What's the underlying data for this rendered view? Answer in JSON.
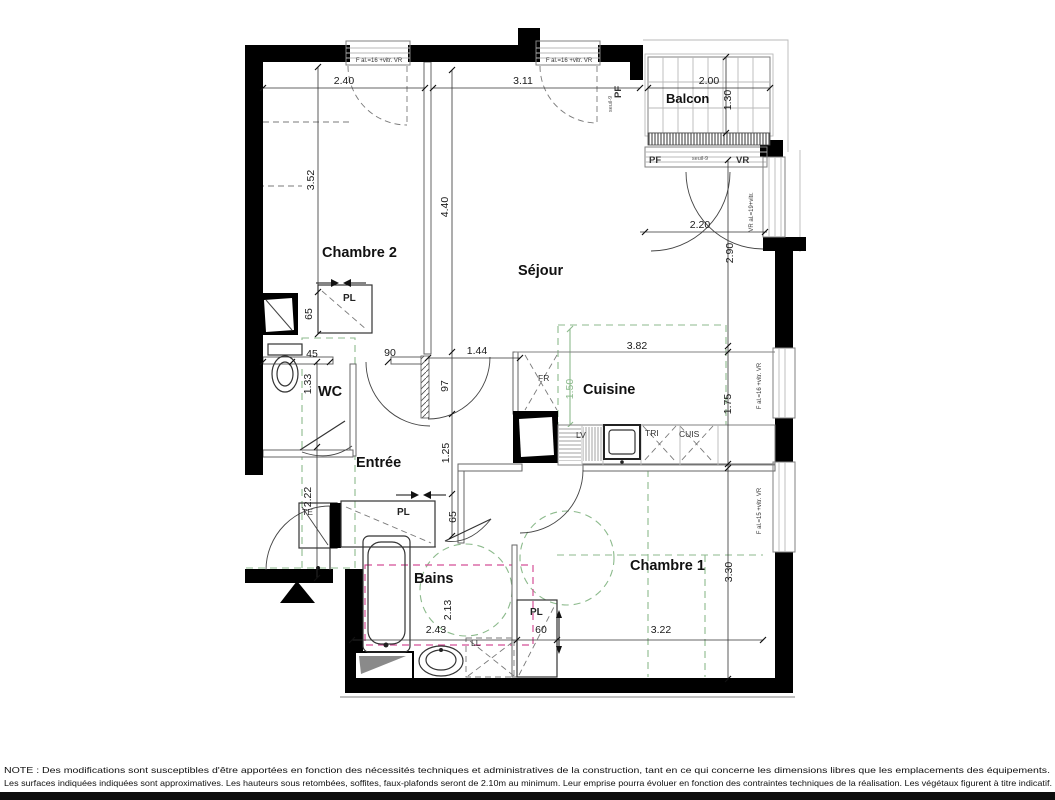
{
  "rooms": [
    "Chambre 2",
    "Séjour",
    "WC",
    "Cuisine",
    "Entrée",
    "Bains",
    "Chambre 1",
    "Balcon"
  ],
  "dims_h": [
    "2.40",
    "3.11",
    "2.00",
    "2.20",
    "45",
    "90",
    "1.44",
    "3.82",
    "2.43",
    "60",
    "3.22"
  ],
  "dims_v": [
    "3.52",
    "4.40",
    "1.30",
    "2.90",
    "65",
    "1.33",
    "97",
    "1.25",
    "65",
    "2.22",
    "1.75",
    "2.13",
    "3.30",
    "1.50"
  ],
  "fixtures": [
    "PL",
    "PL",
    "PL",
    "TE",
    "LL",
    "FR",
    "LV",
    "TRI",
    "CUIS"
  ],
  "openings": {
    "pf": "PF",
    "vr": "VR",
    "seuil": "seuil-9",
    "window_top": "F al.=16 +vitr. VR",
    "window_side": "VR al.=19+vitr.",
    "window_kitchen": "F al.=16 +vitr. VR",
    "window_bedroom1": "F al.=15 +vitr. VR"
  },
  "note": {
    "line1": "NOTE :   Des modifications sont susceptibles d'être apportées en fonction des nécessités techniques et administratives de la construction, tant en ce qui concerne les dimensions libres que les emplacements des équipements.",
    "line2": "Les surfaces indiquées indiquées sont approximatives. Les hauteurs sous retombées, soffites, faux-plafonds seront de 2.10m au minimum. Leur emprise pourra évoluer en fonction des contraintes techniques de la réalisation. Les végétaux figurent à titre indicatif."
  },
  "colors": {
    "wall": "#000000",
    "partition": "#666666",
    "green": "#8cba8c",
    "pink": "#d44f96",
    "dim_text": "#1a1a1a"
  }
}
